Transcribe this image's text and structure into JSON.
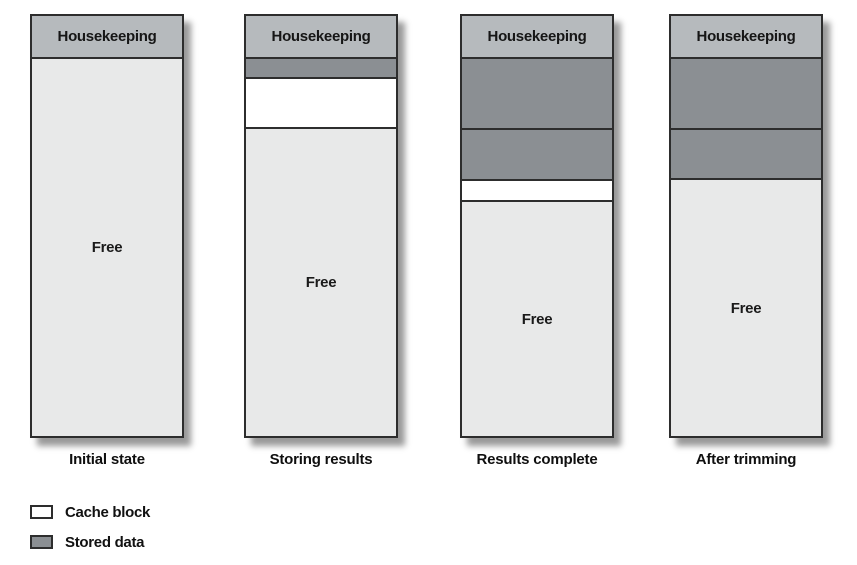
{
  "diagram": {
    "columns": [
      {
        "id": "initial-state",
        "header": "Housekeeping",
        "caption": "Initial state",
        "segments": [
          {
            "type": "free",
            "label": "Free"
          }
        ]
      },
      {
        "id": "storing-results",
        "header": "Housekeeping",
        "caption": "Storing results",
        "segments": [
          {
            "type": "stored",
            "height": 20
          },
          {
            "type": "cache",
            "height": 50
          },
          {
            "type": "free",
            "label": "Free"
          }
        ]
      },
      {
        "id": "results-complete",
        "header": "Housekeeping",
        "caption": "Results complete",
        "segments": [
          {
            "type": "stored",
            "height": 71
          },
          {
            "type": "stored",
            "height": 51
          },
          {
            "type": "cache",
            "height": 21
          },
          {
            "type": "free",
            "label": "Free"
          }
        ]
      },
      {
        "id": "after-trimming",
        "header": "Housekeeping",
        "caption": "After trimming",
        "segments": [
          {
            "type": "stored",
            "height": 71
          },
          {
            "type": "stored",
            "height": 50
          },
          {
            "type": "free",
            "label": "Free"
          }
        ]
      }
    ]
  },
  "legend": {
    "items": [
      {
        "swatch": "cache",
        "label": "Cache block"
      },
      {
        "swatch": "stored",
        "label": "Stored data"
      }
    ]
  },
  "colors": {
    "housekeeping_header": "#b6babd",
    "stored_data": "#8b8f93",
    "cache_block": "#ffffff",
    "free": "#e8e9e9",
    "border": "#2d2d2d"
  }
}
